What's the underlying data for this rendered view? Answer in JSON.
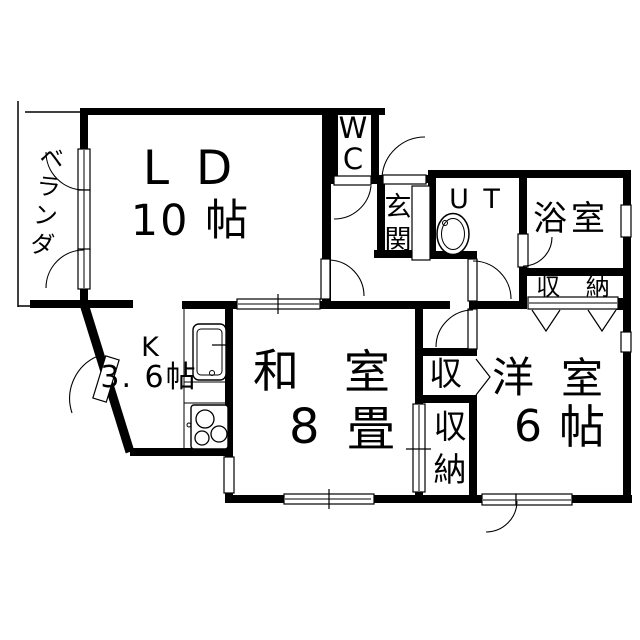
{
  "meta": {
    "type": "floor-plan",
    "background_color": "#ffffff",
    "wall_color": "#000000"
  },
  "rooms": {
    "balcony": {
      "label": "ベ\nラ\nン\nダ"
    },
    "living_dining": {
      "name_line": "L D",
      "size_line": "10 帖"
    },
    "wc": {
      "char1": "W",
      "char2": "C"
    },
    "entrance": {
      "char1": "玄",
      "char2": "関"
    },
    "utility": {
      "label": "U T"
    },
    "bathroom": {
      "label": "浴室"
    },
    "storage_upper": {
      "label": "収 納"
    },
    "kitchen": {
      "name": "K",
      "size": "3. 6帖"
    },
    "japanese_room": {
      "kanji1": "和",
      "kanji2": "室",
      "size_num": "8",
      "size_unit": "畳"
    },
    "storage_middle": {
      "label": "収"
    },
    "storage_lower": {
      "char1": "収",
      "char2": "納"
    },
    "western_room": {
      "kanji1": "洋",
      "kanji2": "室",
      "size_num": "6",
      "size_unit": "帖"
    }
  }
}
